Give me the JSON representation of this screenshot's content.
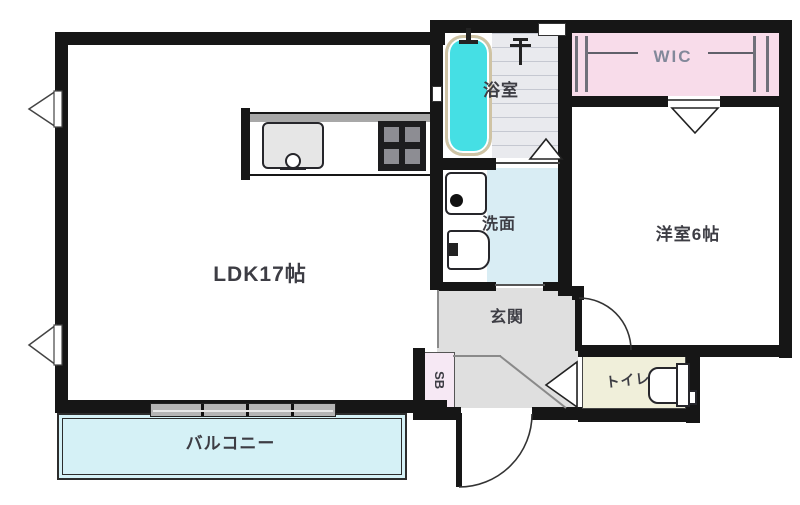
{
  "rooms": {
    "ldk": {
      "label": "LDK17帖"
    },
    "bathroom": {
      "label": "浴室"
    },
    "washroom": {
      "label": "洗面"
    },
    "wic": {
      "label": "WIC"
    },
    "western_room": {
      "label": "洋室6帖"
    },
    "entrance": {
      "label": "玄関"
    },
    "toilet": {
      "label": "トイレ"
    },
    "shoe_box": {
      "label": "SB"
    },
    "balcony": {
      "label": "バルコニー"
    }
  },
  "colors": {
    "wall": "#161616",
    "bathtub_fill": "#45dfe4",
    "bathtub_border": "#cfc3a4",
    "bath_tile": "#e9eaee",
    "wic_fill": "#f8dcea",
    "washroom_fill": "#d9edf4",
    "entrance_fill": "#dfdfdf",
    "toilet_fill": "#f0efda",
    "shoe_box_fill": "#f6e8f4",
    "balcony_fill": "#d5f1f6",
    "window_band": "#b5b5b5"
  }
}
